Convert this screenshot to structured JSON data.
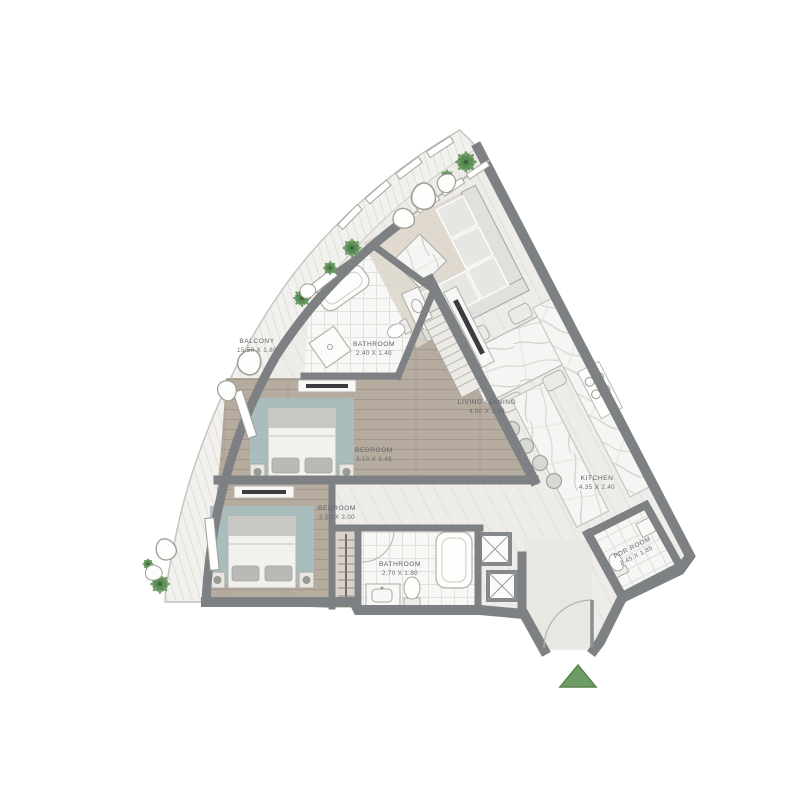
{
  "plan": {
    "title": "apartment-floor-plan",
    "rooms": [
      {
        "id": "balcony",
        "name": "BALCONY",
        "dims": "15.50 X 1.80"
      },
      {
        "id": "bathroom-1",
        "name": "BATHROOM",
        "dims": "2.40 X 1.40"
      },
      {
        "id": "living-dining",
        "name": "LIVING / DINING",
        "dims": "4.80 X 3.98"
      },
      {
        "id": "bedroom-1",
        "name": "BEDROOM",
        "dims": "3.10 X 3.48"
      },
      {
        "id": "kitchen",
        "name": "KITCHEN",
        "dims": "4.35 X 2.40"
      },
      {
        "id": "bedroom-2",
        "name": "BEDROOM",
        "dims": "3.50 X 3.00"
      },
      {
        "id": "bathroom-2",
        "name": "BATHROOM",
        "dims": "2.70 X 1.80"
      },
      {
        "id": "pdr-room",
        "name": "PDR ROOM",
        "dims": "2.45 X 1.85"
      }
    ],
    "entry_marker": {
      "icon": "triangle-up",
      "color": "#6e9c67"
    },
    "colors": {
      "wall": "#7d8183",
      "floor_light": "#edece8",
      "floor_wood": "#b6ab9f",
      "tile": "#f7f7f5",
      "deck": "#f2f1ed",
      "rug_teal": "#a9bfc0",
      "rug_beige": "#dcd6ca",
      "marble": "#f5f5f3",
      "plant_green": "#6a9a63",
      "label_text": "#5d6268"
    }
  }
}
